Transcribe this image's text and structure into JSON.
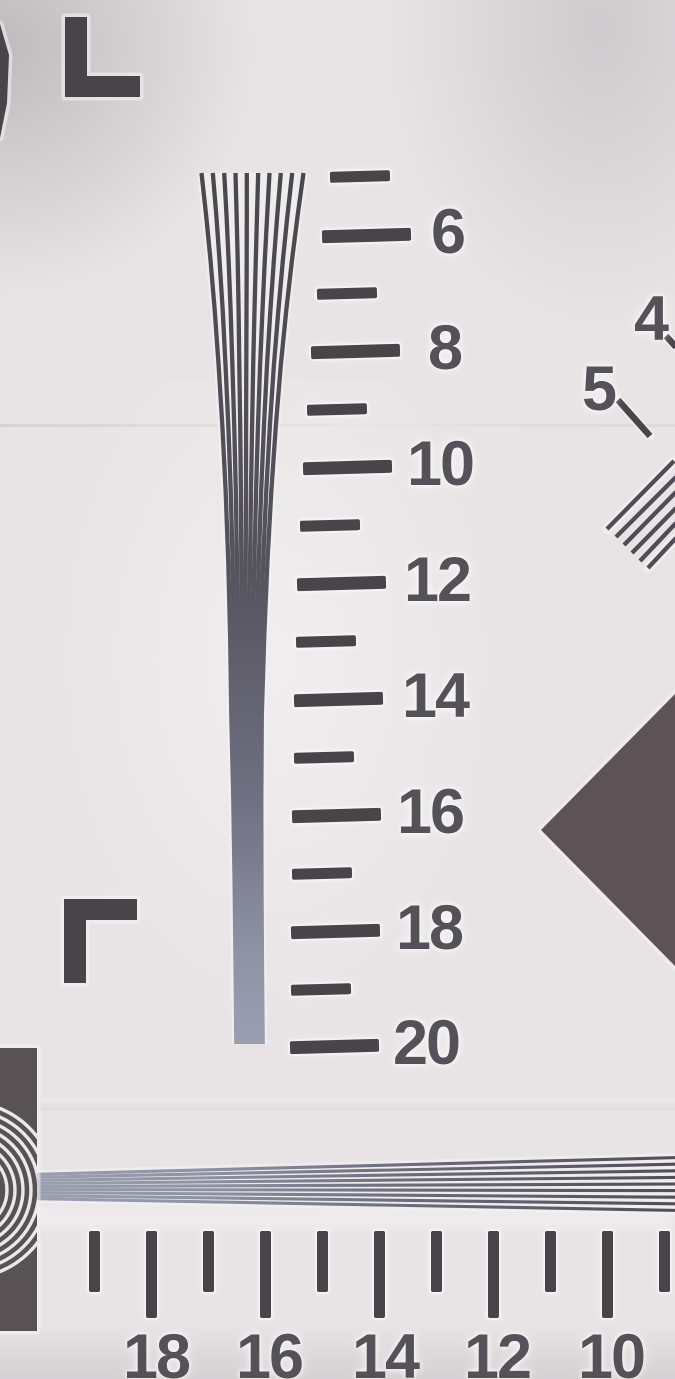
{
  "vertical_ruler": {
    "labels": [
      "6",
      "8",
      "10",
      "12",
      "14",
      "16",
      "18",
      "20"
    ]
  },
  "horizontal_ruler": {
    "labels": [
      "18",
      "16",
      "14",
      "12",
      "10"
    ]
  },
  "annotations": {
    "four": "4",
    "five": "5"
  },
  "colors": {
    "paper": "#e8e4e6",
    "ink": "#48444a",
    "label_ink": "#555158",
    "stripe_dark": "#504c55",
    "stripe_merged": "#9aa0b0",
    "diamond": "#5d5256",
    "corner_block": "#595254",
    "arc_white": "#eae8ea",
    "halo": "#f6f4f5"
  }
}
